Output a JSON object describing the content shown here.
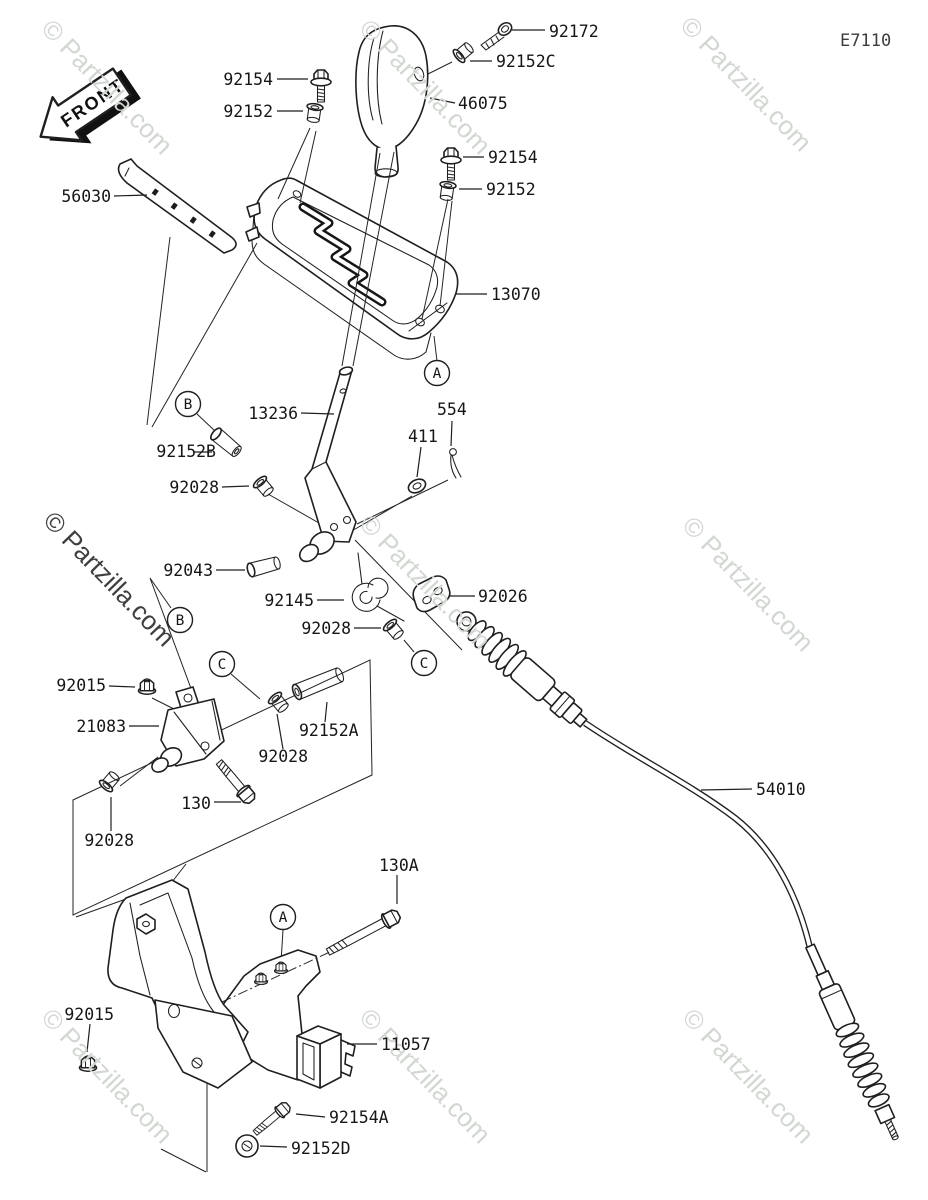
{
  "diagram": {
    "code": "E7110",
    "front_label": "FRONT",
    "watermark_text": "© Partzilla.com",
    "callouts": {
      "a": "A",
      "b": "B",
      "c": "C"
    },
    "labels": [
      "92172",
      "92152C",
      "92154",
      "92152",
      "46075",
      "56030",
      "92154",
      "92152",
      "13070",
      "13236",
      "554",
      "411",
      "92152B",
      "92028",
      "92043",
      "92145",
      "92026",
      "92028",
      "92015",
      "21083",
      "92152A",
      "92028",
      "130",
      "92028",
      "130A",
      "92015",
      "11057",
      "92154A",
      "92152D",
      "54010"
    ]
  }
}
